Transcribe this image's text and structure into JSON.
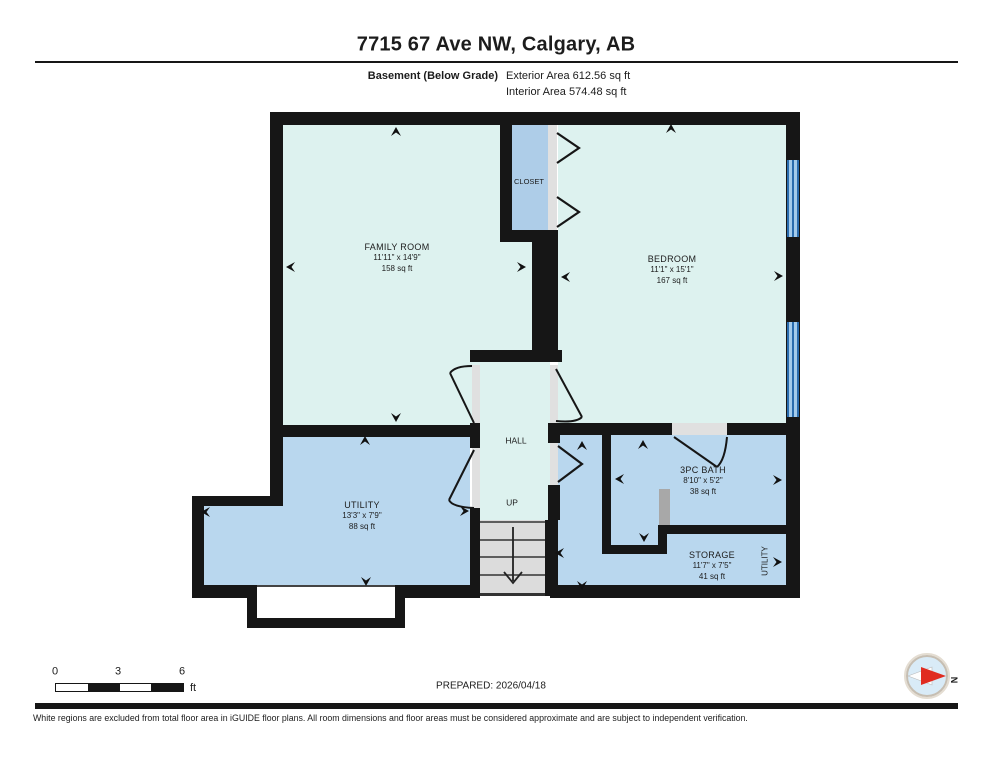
{
  "header": {
    "title": "7715 67 Ave NW, Calgary, AB",
    "floor_label": "Basement (Below Grade)",
    "exterior_area": "Exterior Area 612.56 sq ft",
    "interior_area": "Interior Area 574.48 sq ft"
  },
  "rooms": {
    "family_room": {
      "name": "FAMILY ROOM",
      "dims": "11'11\" x 14'9\"",
      "area": "158 sq ft"
    },
    "bedroom": {
      "name": "BEDROOM",
      "dims": "11'1\" x 15'1\"",
      "area": "167 sq ft"
    },
    "closet": {
      "name": "CLOSET"
    },
    "hall": {
      "name": "HALL"
    },
    "stairs_up": "UP",
    "utility": {
      "name": "UTILITY",
      "dims": "13'3\" x 7'9\"",
      "area": "88 sq ft"
    },
    "bath": {
      "name": "3PC BATH",
      "dims": "8'10\" x 5'2\"",
      "area": "38 sq ft"
    },
    "storage": {
      "name": "STORAGE",
      "dims": "11'7\" x 7'5\"",
      "area": "41 sq ft"
    },
    "utility_vertical_label": "UTILITY"
  },
  "footer": {
    "scale_ticks": [
      "0",
      "3",
      "6"
    ],
    "scale_unit": "ft",
    "prepared": "PREPARED: 2026/04/18",
    "compass_north": "N",
    "disclaimer": "White regions are excluded from total floor area in iGUIDE floor plans. All room dimensions and floor areas must be considered approximate and are subject to independent verification."
  },
  "colors": {
    "wall": "#161616",
    "room_light": "#ddf2ef",
    "room_blue": "#b9d7ee",
    "closet_blue": "#aecde8",
    "stairs_gray": "#dcdcdc",
    "window_blue": "#2a6cae",
    "compass_red": "#e02b20"
  }
}
